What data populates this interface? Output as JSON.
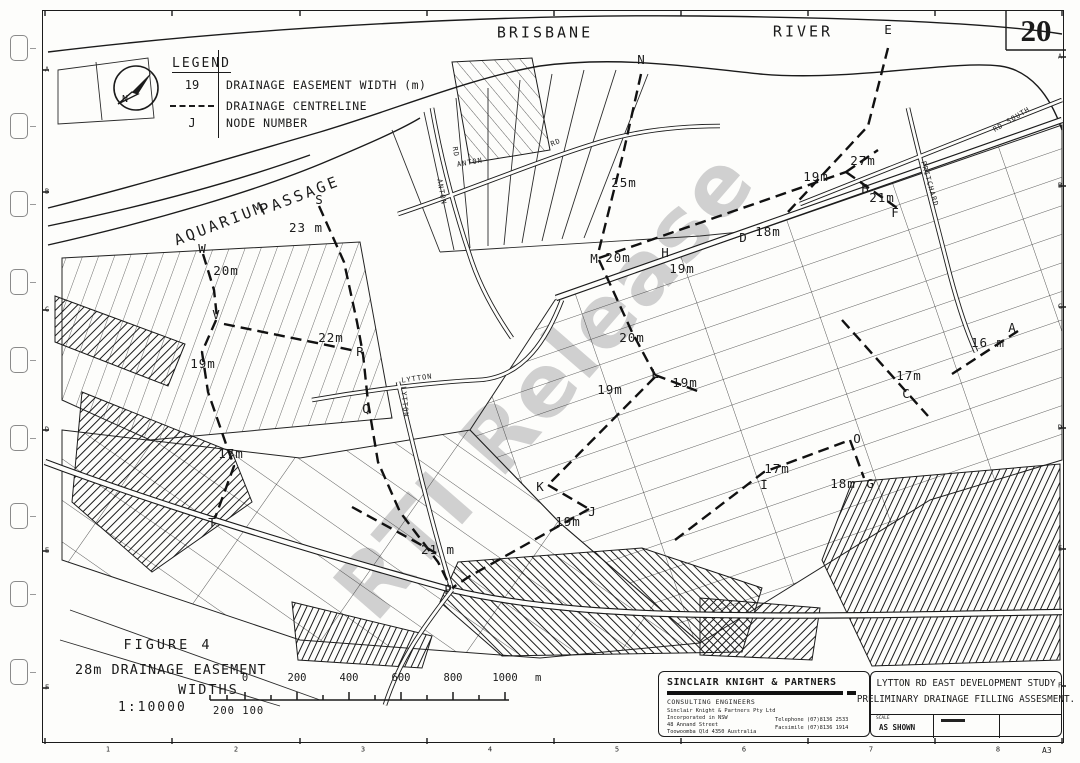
{
  "page": {
    "number": "20"
  },
  "sheet": {
    "size": "A3"
  },
  "watermark": {
    "text": "RTI Release"
  },
  "legend": {
    "title": "LEGEND",
    "rows": [
      {
        "symbol": "19",
        "label": "DRAINAGE EASEMENT WIDTH (m)"
      },
      {
        "symbol": "dash",
        "label": "DRAINAGE CENTRELINE"
      },
      {
        "symbol": "J",
        "label": "NODE NUMBER"
      }
    ],
    "north_arrow": "north-arrow"
  },
  "figure": {
    "title": "FIGURE 4",
    "line1": "28m DRAINAGE EASEMENT",
    "line2": "WIDTHS",
    "scale": "1:10000",
    "scalebar_labels": [
      "0",
      "200",
      "400",
      "600",
      "800",
      "1000"
    ],
    "scalebar_unit": "m",
    "scalebar_sub": "200 100"
  },
  "consultant": {
    "name": "SINCLAIR KNIGHT & PARTNERS",
    "subtitle": "CONSULTING ENGINEERS",
    "address_lines": [
      "Sinclair Knight & Partners Pty Ltd",
      "Incorporated in NSW",
      "48 Annand Street",
      "Toowoomba Qld 4350 Australia"
    ],
    "telephone": "Telephone (07)8136 2533",
    "facsimile": "Facsimile (07)8136 1914"
  },
  "project": {
    "line1": "LYTTON RD EAST DEVELOPMENT STUDY",
    "line2": "PRELIMINARY DRAINAGE FILLING ASSESMENT.",
    "scale_label": "SCALE",
    "scale_value": "AS SHOWN"
  },
  "grid": {
    "row_letters": [
      "A",
      "B",
      "C",
      "D",
      "E",
      "F"
    ],
    "col_numbers": [
      "1",
      "2",
      "3",
      "4",
      "5",
      "6",
      "7",
      "8"
    ]
  },
  "colors": {
    "ink": "#1b1b1b",
    "paper": "#fdfdfb",
    "watermark": "#c9c9c9"
  },
  "map": {
    "annotations": [
      {
        "t": "BRISBANE",
        "x": 545,
        "y": 33,
        "c": "place"
      },
      {
        "t": "RIVER",
        "x": 803,
        "y": 32,
        "c": "place"
      },
      {
        "t": "AQUARIUM",
        "x": 220,
        "y": 224,
        "c": "place",
        "r": -21
      },
      {
        "t": "PASSAGE",
        "x": 300,
        "y": 196,
        "c": "place",
        "r": -21
      },
      {
        "t": "E",
        "x": 888,
        "y": 30,
        "c": "node"
      },
      {
        "t": "N",
        "x": 641,
        "y": 60,
        "c": "node"
      },
      {
        "t": "M",
        "x": 594,
        "y": 259,
        "c": "node"
      },
      {
        "t": "H",
        "x": 665,
        "y": 253,
        "c": "node"
      },
      {
        "t": "D",
        "x": 743,
        "y": 238,
        "c": "node"
      },
      {
        "t": "B",
        "x": 865,
        "y": 189,
        "c": "node"
      },
      {
        "t": "F",
        "x": 895,
        "y": 213,
        "c": "node"
      },
      {
        "t": "S",
        "x": 319,
        "y": 200,
        "c": "node"
      },
      {
        "t": "W",
        "x": 202,
        "y": 249,
        "c": "node"
      },
      {
        "t": "V",
        "x": 216,
        "y": 315,
        "c": "node"
      },
      {
        "t": "R",
        "x": 360,
        "y": 352,
        "c": "node"
      },
      {
        "t": "Q",
        "x": 366,
        "y": 409,
        "c": "node"
      },
      {
        "t": "T",
        "x": 212,
        "y": 523,
        "c": "node"
      },
      {
        "t": "P",
        "x": 448,
        "y": 590,
        "c": "node"
      },
      {
        "t": "K",
        "x": 540,
        "y": 487,
        "c": "node"
      },
      {
        "t": "J",
        "x": 592,
        "y": 512,
        "c": "node"
      },
      {
        "t": "L",
        "x": 655,
        "y": 374,
        "c": "node"
      },
      {
        "t": "I",
        "x": 764,
        "y": 485,
        "c": "node"
      },
      {
        "t": "O",
        "x": 857,
        "y": 439,
        "c": "node"
      },
      {
        "t": "G",
        "x": 870,
        "y": 484,
        "c": "node"
      },
      {
        "t": "C",
        "x": 906,
        "y": 394,
        "c": "node"
      },
      {
        "t": "A",
        "x": 1012,
        "y": 328,
        "c": "node"
      },
      {
        "t": "23 m",
        "x": 306,
        "y": 228,
        "c": "measure"
      },
      {
        "t": "20m",
        "x": 226,
        "y": 271,
        "c": "measure"
      },
      {
        "t": "25m",
        "x": 624,
        "y": 183,
        "c": "measure"
      },
      {
        "t": "20m",
        "x": 618,
        "y": 258,
        "c": "measure"
      },
      {
        "t": "19m",
        "x": 682,
        "y": 269,
        "c": "measure"
      },
      {
        "t": "18m",
        "x": 768,
        "y": 232,
        "c": "measure"
      },
      {
        "t": "19m",
        "x": 816,
        "y": 177,
        "c": "measure"
      },
      {
        "t": "27m",
        "x": 863,
        "y": 161,
        "c": "measure"
      },
      {
        "t": "21m",
        "x": 882,
        "y": 198,
        "c": "measure"
      },
      {
        "t": "22m",
        "x": 331,
        "y": 338,
        "c": "measure"
      },
      {
        "t": "19m",
        "x": 203,
        "y": 364,
        "c": "measure"
      },
      {
        "t": "17m",
        "x": 231,
        "y": 454,
        "c": "measure"
      },
      {
        "t": "20m",
        "x": 632,
        "y": 338,
        "c": "measure"
      },
      {
        "t": "19m",
        "x": 610,
        "y": 390,
        "c": "measure"
      },
      {
        "t": "19m",
        "x": 685,
        "y": 383,
        "c": "measure"
      },
      {
        "t": "19m",
        "x": 568,
        "y": 522,
        "c": "measure"
      },
      {
        "t": "21 m",
        "x": 438,
        "y": 550,
        "c": "measure"
      },
      {
        "t": "17m",
        "x": 777,
        "y": 469,
        "c": "measure"
      },
      {
        "t": "18m",
        "x": 843,
        "y": 484,
        "c": "measure"
      },
      {
        "t": "17m",
        "x": 909,
        "y": 376,
        "c": "measure"
      },
      {
        "t": "16 m",
        "x": 988,
        "y": 343,
        "c": "measure"
      },
      {
        "t": "ANTON",
        "x": 470,
        "y": 163,
        "c": "road",
        "r": -10
      },
      {
        "t": "RD",
        "x": 556,
        "y": 143,
        "c": "road",
        "r": -22
      },
      {
        "t": "ANTON",
        "x": 441,
        "y": 192,
        "c": "road",
        "r": 80
      },
      {
        "t": "RD",
        "x": 455,
        "y": 152,
        "c": "road",
        "r": 80
      },
      {
        "t": "LYTTON",
        "x": 417,
        "y": 379,
        "c": "road",
        "r": -8
      },
      {
        "t": "LYTTON",
        "x": 404,
        "y": 402,
        "c": "road",
        "r": 85
      },
      {
        "t": "PRITCHARD",
        "x": 929,
        "y": 184,
        "c": "road",
        "r": 74
      },
      {
        "t": "RD SOUTH",
        "x": 1012,
        "y": 120,
        "c": "road",
        "r": -31
      }
    ]
  }
}
